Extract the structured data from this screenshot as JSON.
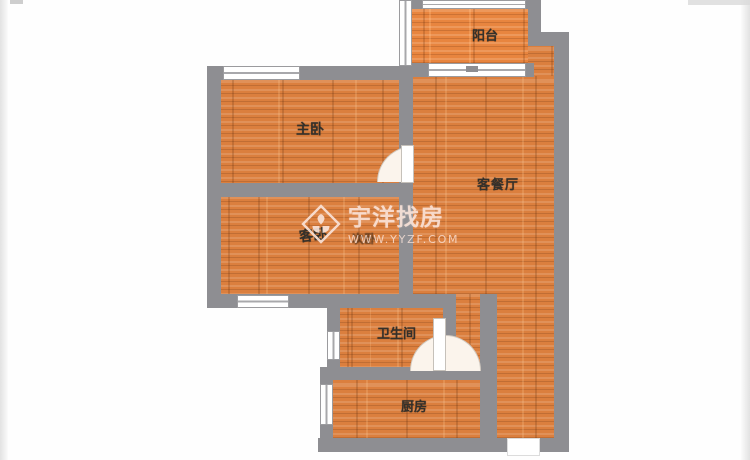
{
  "plan": {
    "rooms": {
      "balcony": {
        "label": "阳台"
      },
      "master_bedroom": {
        "label": "主卧"
      },
      "living_dining": {
        "label": "客餐厅"
      },
      "guest_bedroom": {
        "label": "客卧"
      },
      "guest_bedroom_original": {
        "label": "次卧"
      },
      "bathroom": {
        "label": "卫生间"
      },
      "kitchen": {
        "label": "厨房"
      }
    },
    "watermark": {
      "brand": "宇洋找房",
      "website": "WWW.YYZF.COM"
    },
    "colors": {
      "wall": "#8e8e92",
      "floor": "#db7f3e",
      "floor_seam": "#c9702f",
      "label_text": "#34302a",
      "watermark": "#fae4da"
    }
  }
}
